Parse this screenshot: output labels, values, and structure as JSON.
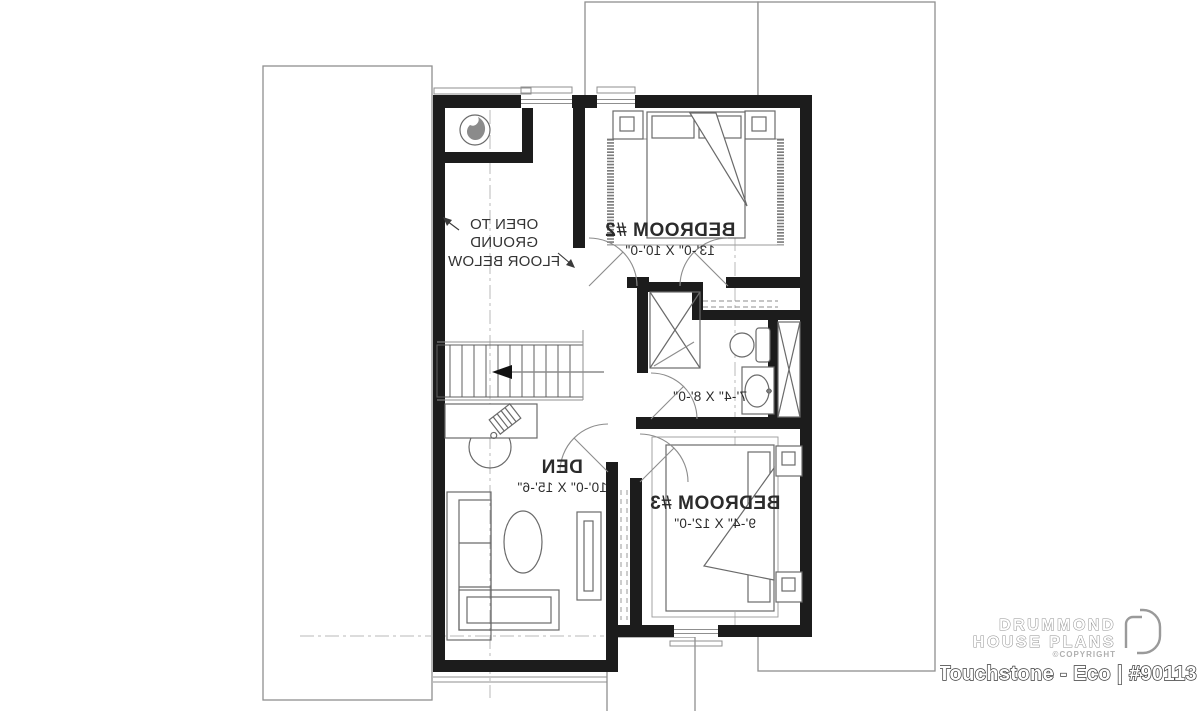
{
  "plan": {
    "open_area": {
      "line1": "OPEN TO GROUND",
      "line2": "FLOOR BELOW"
    },
    "bedroom2": {
      "name": "BEDROOM #2",
      "dims": "13'-0\" X 10'-0\""
    },
    "bathroom": {
      "dims": "7'-4\" X 8'-0\""
    },
    "den": {
      "name": "DEN",
      "dims": "10'-0\" X 15'-6\""
    },
    "bedroom3": {
      "name": "BEDROOM #3",
      "dims": "9'-4\" X 12'-0\""
    }
  },
  "branding": {
    "brand_line1": "DRUMMOND",
    "brand_line2": "HOUSE PLANS",
    "copyright": "©COPYRIGHT",
    "plan_title": "Touchstone - Eco | #90113"
  },
  "colors": {
    "wall": "#1c1c1c",
    "furniture_line": "#6a6a6a",
    "roof_line": "#8f8f8f",
    "label_text": "#2b2b2b",
    "logo_outline": "#8f8f8f"
  }
}
